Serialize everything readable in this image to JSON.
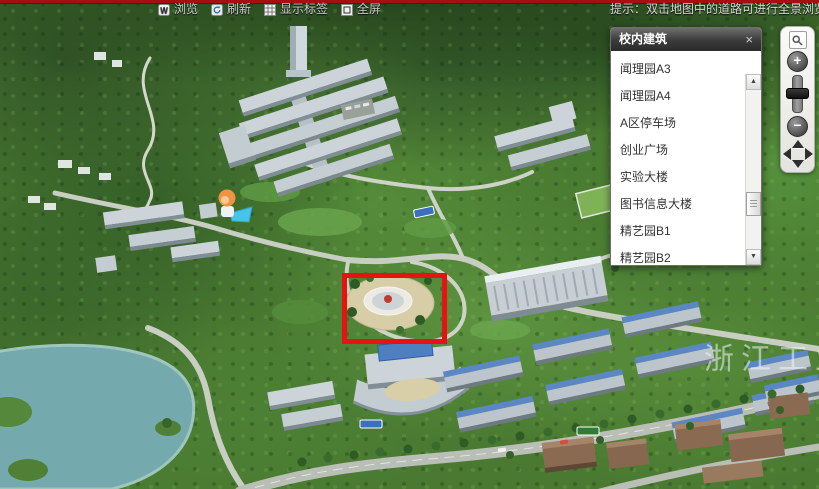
{
  "topbar": {
    "buttons": [
      {
        "label": "浏览",
        "icon": "hand-browse-icon"
      },
      {
        "label": "刷新",
        "icon": "refresh-icon"
      },
      {
        "label": "显示标签",
        "icon": "show-labels-icon"
      },
      {
        "label": "全屏",
        "icon": "fullscreen-icon"
      }
    ],
    "hint": "提示：双击地图中的道路可进行全景浏览"
  },
  "buildings_panel": {
    "title": "校内建筑",
    "close_glyph": "×",
    "scroll_up_glyph": "▲",
    "scroll_down_glyph": "▼",
    "items": [
      "闻理园A3",
      "闻理园A4",
      "A区停车场",
      "创业广场",
      "实验大楼",
      "图书信息大楼",
      "精艺园B1",
      "精艺园B2"
    ]
  },
  "zoom_control": {
    "zoom_in_glyph": "+",
    "zoom_out_glyph": "−"
  },
  "map": {
    "watermark": "浙江工业",
    "annotation_color": "#e81212",
    "accent_strip_color": "#a31010",
    "lake_color": "#74aaad"
  }
}
